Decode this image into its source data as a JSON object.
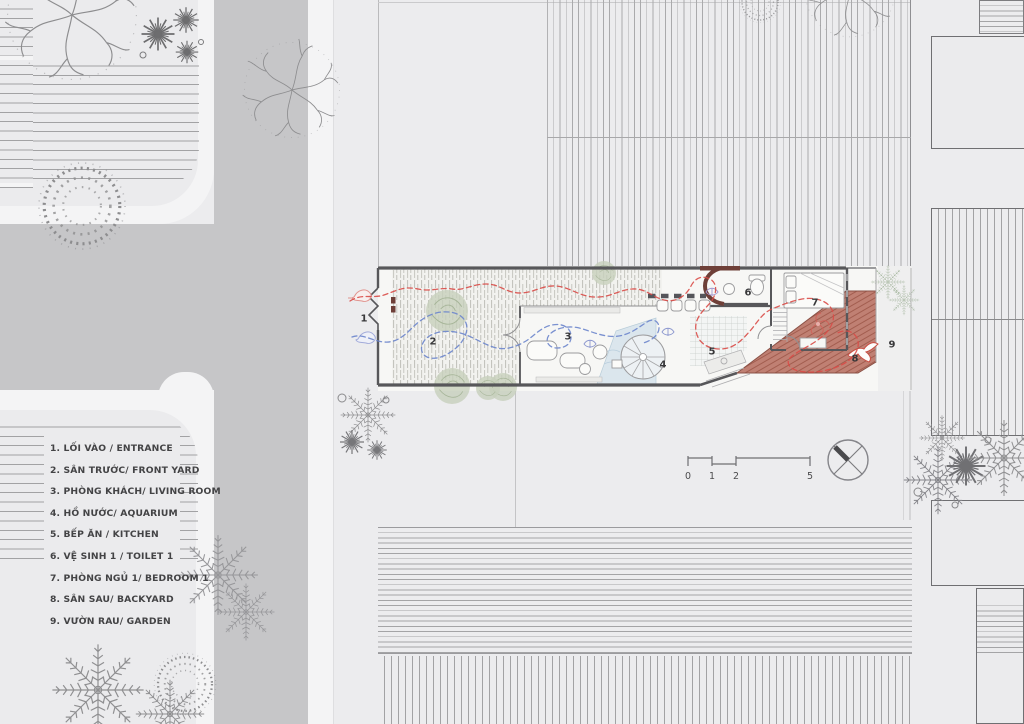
{
  "legend": {
    "items": [
      {
        "text": "1. LỐI VÀO / ENTRANCE"
      },
      {
        "text": "2. SÂN TRƯỚC/ FRONT YARD"
      },
      {
        "text": "3. PHÒNG KHÁCH/ LIVING ROOM"
      },
      {
        "text": "4. HỒ NƯỚC/ AQUARIUM"
      },
      {
        "text": "5. BẾP ĂN / KITCHEN"
      },
      {
        "text": "6. VỆ SINH 1 / TOILET 1"
      },
      {
        "text": "7. PHÒNG NGỦ 1/ BEDROOM 1"
      },
      {
        "text": "8. SÂN SAU/ BACKYARD"
      },
      {
        "text": "9. VƯỜN RAU/ GARDEN"
      }
    ]
  },
  "plan": {
    "labels": [
      "1",
      "2",
      "3",
      "4",
      "5",
      "6",
      "7",
      "8",
      "9"
    ]
  },
  "scale_bar": {
    "ticks": [
      "0",
      "1",
      "2",
      "5"
    ]
  },
  "colors": {
    "background": "#ececee",
    "road": "#c6c6c8",
    "sidewalk": "#f4f4f5",
    "house_wall": "#57575a",
    "accent_wall": "#6e3f38",
    "backyard_terracotta": "#c08073",
    "circulation_red": "#d94b47",
    "circulation_blue": "#6b85cc",
    "aquarium_blue": "#d5e3ec",
    "vegetation_green": "#c7d0bc"
  }
}
